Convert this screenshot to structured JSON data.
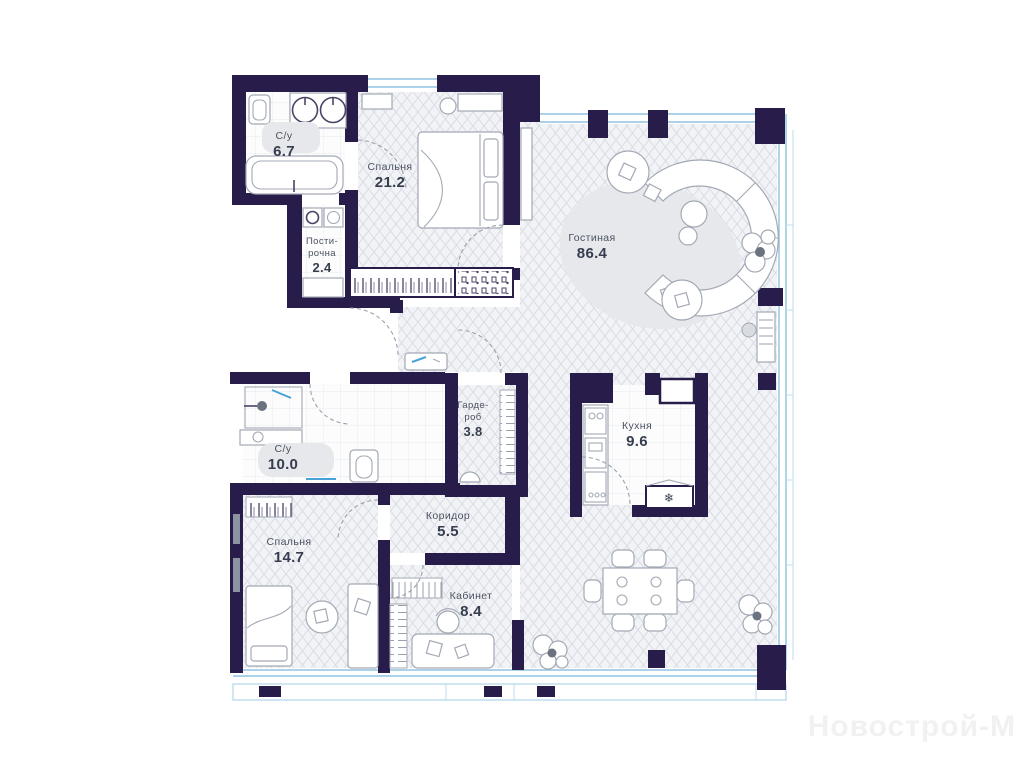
{
  "watermark": "Новострой-М",
  "rooms": {
    "bathroom1": {
      "name": "С/у",
      "area": "6.7"
    },
    "bedroom1": {
      "name": "Спальня",
      "area": "21.2"
    },
    "laundry": {
      "line1": "Пости-",
      "line2": "рочна",
      "area": "2.4"
    },
    "living": {
      "name": "Гостиная",
      "area": "86.4"
    },
    "wardrobe": {
      "line1": "Гарде-",
      "line2": "роб",
      "area": "3.8"
    },
    "kitchen": {
      "name": "Кухня",
      "area": "9.6"
    },
    "bathroom2": {
      "name": "С/у",
      "area": "10.0"
    },
    "corridor": {
      "name": "Коридор",
      "area": "5.5"
    },
    "bedroom2": {
      "name": "Спальня",
      "area": "14.7"
    },
    "study": {
      "name": "Кабинет",
      "area": "8.4"
    }
  },
  "icons": {
    "fridge_snowflake": "❄"
  },
  "colors": {
    "wall": "#281c4b",
    "glazing": "#8fc3dd",
    "hatch-line": "#d9dce3",
    "accent-blue": "#4aa3d8",
    "watermark": "#f1f1f1"
  }
}
